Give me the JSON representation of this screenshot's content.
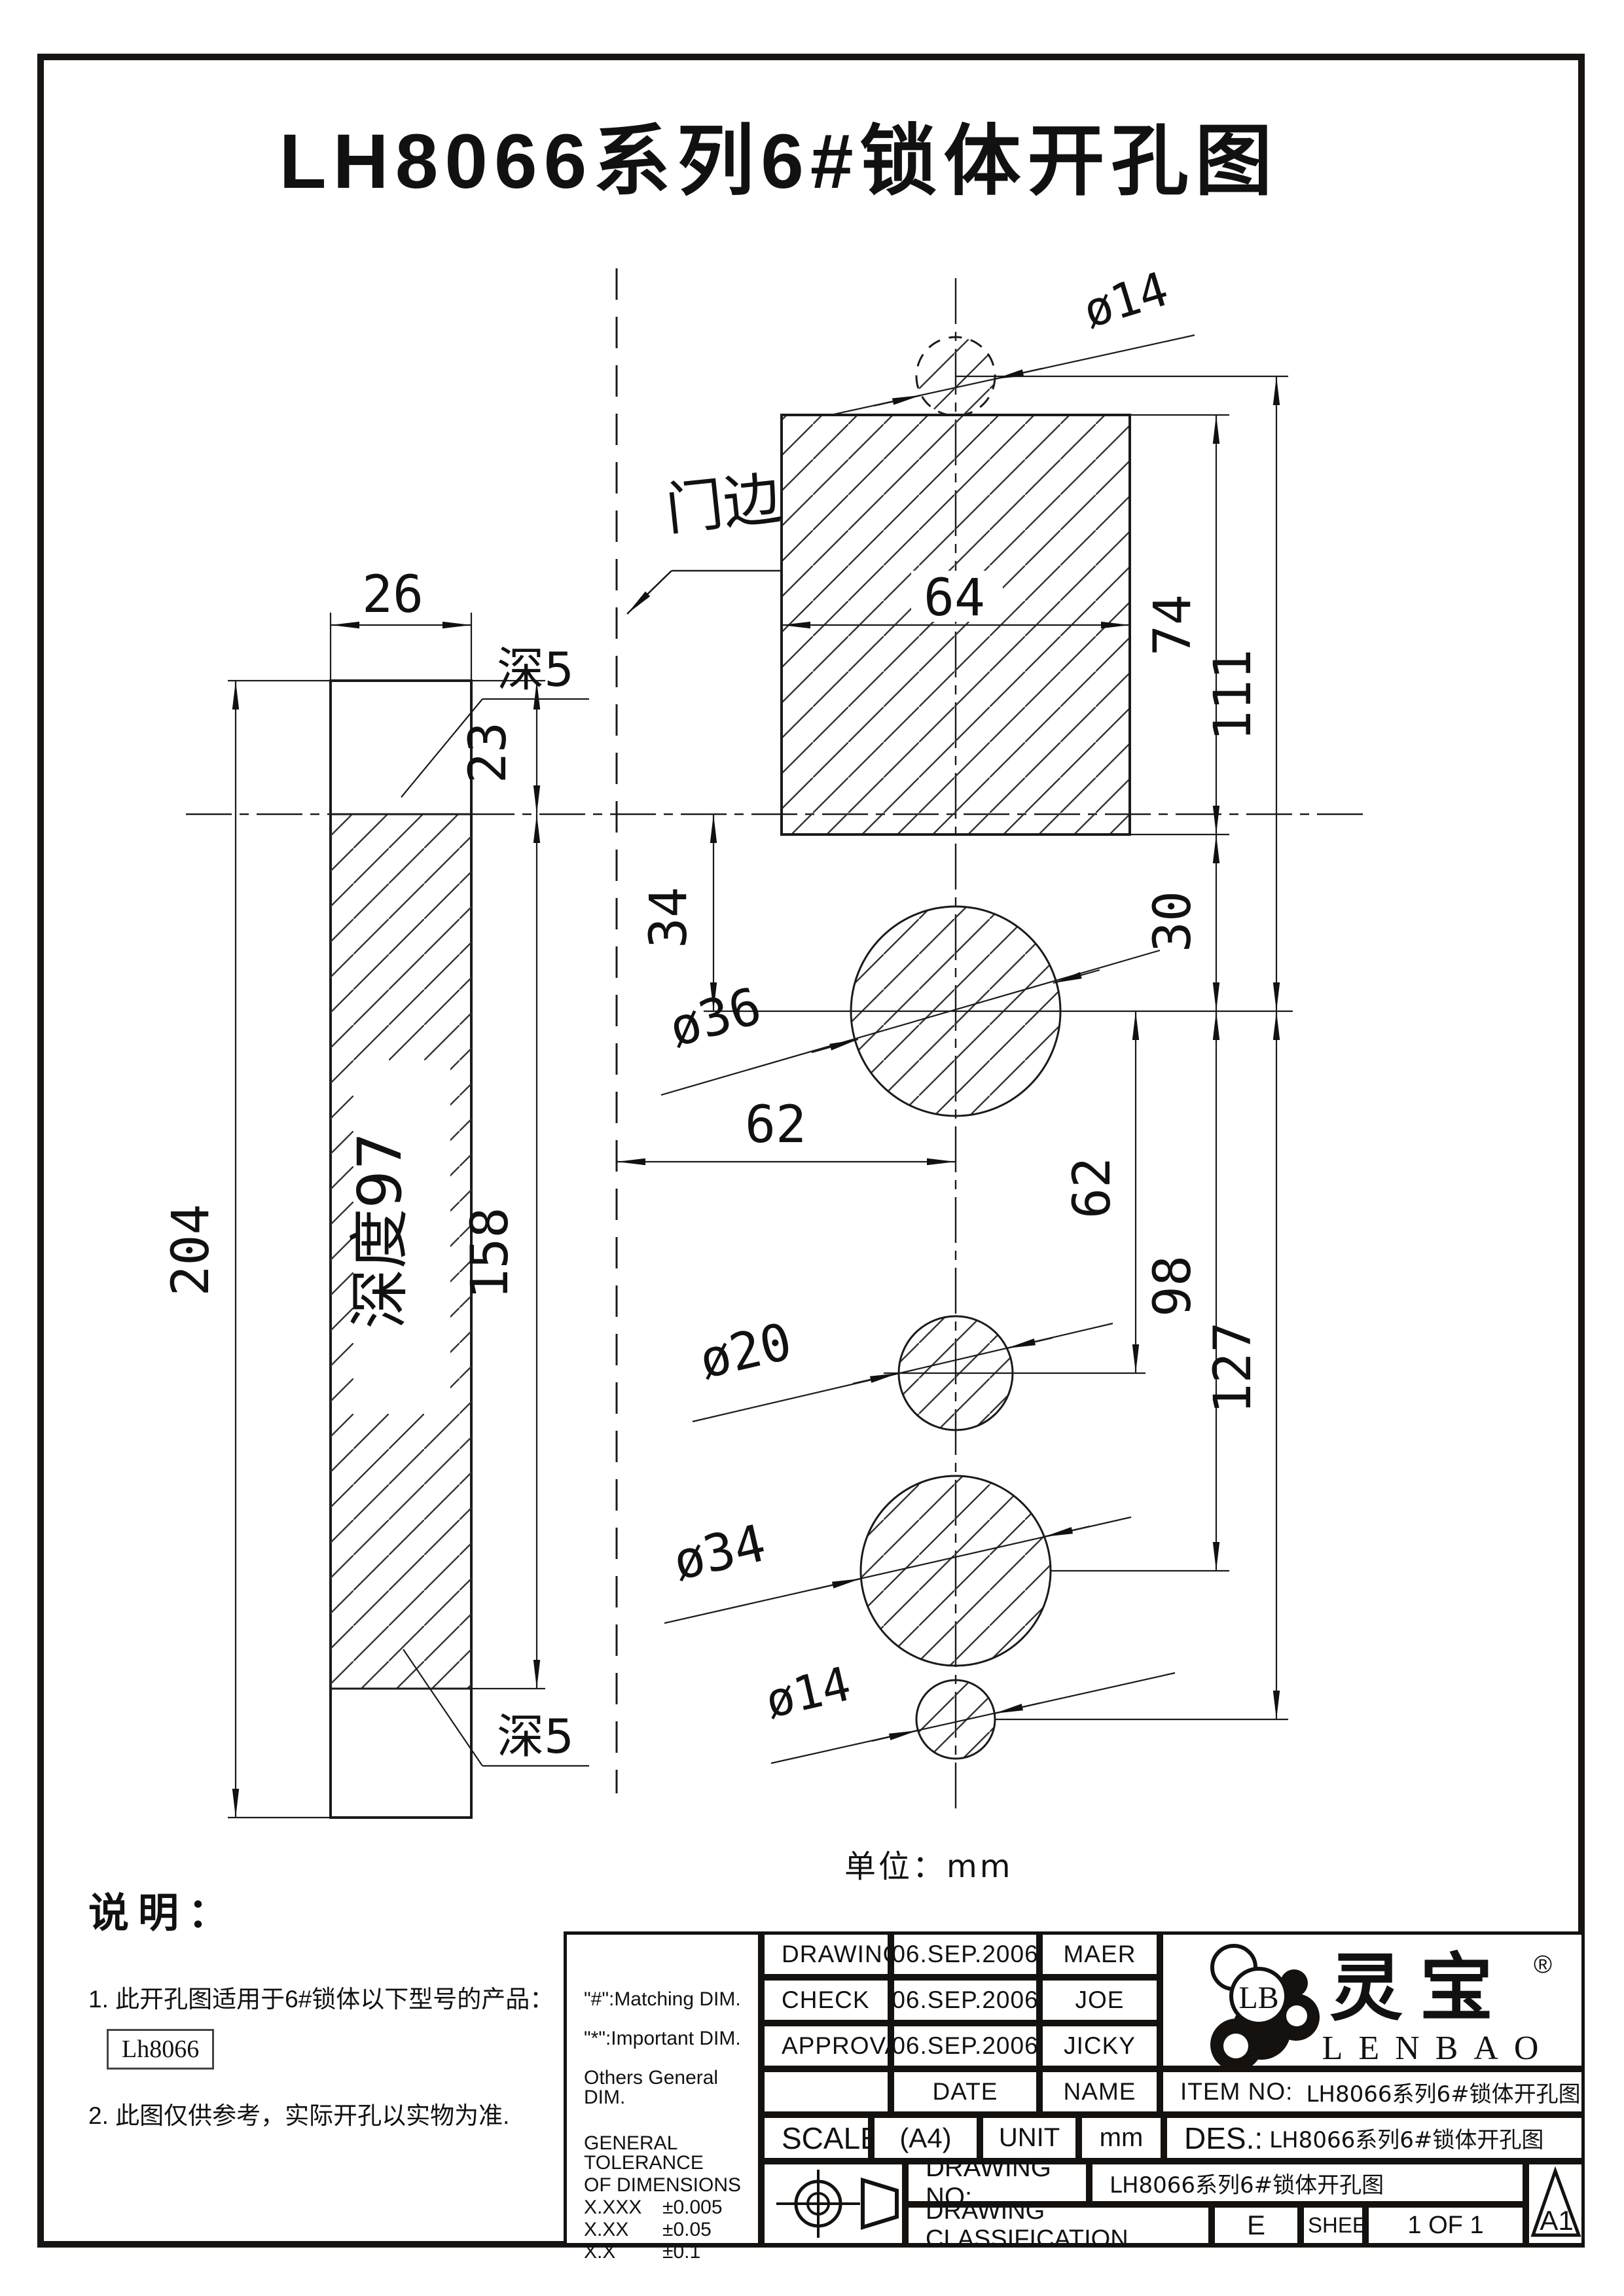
{
  "title": "LH8066系列6#锁体开孔图",
  "unit_note": "单位：mm",
  "drawing": {
    "door_edge_label": "门边",
    "depth_note_top": "深5",
    "depth_note_bottom": "深5",
    "depth_inside": "深度97",
    "dims": {
      "w26": "26",
      "d23": "23",
      "d204": "204",
      "d158": "158",
      "d64": "64",
      "d74": "74",
      "d111": "111",
      "d30": "30",
      "d34": "34",
      "d62v": "62",
      "d62h": "62",
      "d98": "98",
      "d127": "127",
      "dia14_top": "ø14",
      "dia36": "ø36",
      "dia20": "ø20",
      "dia34": "ø34",
      "dia14_bottom": "ø14"
    }
  },
  "notes": {
    "heading": "说明：",
    "item1": "1. 此开孔图适用于6#锁体以下型号的产品：",
    "model_box": "Lh8066",
    "item2": "2. 此图仅供参考，实际开孔以实物为准."
  },
  "titleblock": {
    "rows": [
      {
        "label": "DRAWING",
        "date": "06.SEP.2006",
        "name": "MAER"
      },
      {
        "label": "CHECK",
        "date": "06.SEP.2006",
        "name": "JOE"
      },
      {
        "label": "APPROVAL",
        "date": "06.SEP.2006",
        "name": "JICKY"
      }
    ],
    "date_header": "DATE",
    "name_header": "NAME",
    "item_no_label": "ITEM NO:",
    "item_no_value": "LH8066系列6#锁体开孔图",
    "scale_label": "SCALE",
    "scale_value": "(A4)",
    "unit_label": "UNIT",
    "unit_value": "mm",
    "des_label": "DES.:",
    "des_value": "LH8066系列6#锁体开孔图",
    "drawing_no_label": "DRAWING NO:",
    "drawing_no_value": "LH8066系列6#锁体开孔图",
    "classification_label": "DRAWING CLASSIFICATION",
    "classification_value": "E",
    "sheet_label": "SHEET",
    "sheet_value": "1 OF 1",
    "format_code": "A1",
    "side_notes": [
      "\"#\":Matching  DIM.",
      "\"*\":Important  DIM.",
      "Others General  DIM."
    ],
    "tolerance_title": [
      "GENERAL TOLERANCE",
      "OF DIMENSIONS"
    ],
    "tolerances": [
      [
        "X.XXX",
        "±0.005"
      ],
      [
        "X.XX",
        "±0.05"
      ],
      [
        "X.X",
        "±0.1"
      ]
    ]
  },
  "logo": {
    "monogram": "LB",
    "brand_cn": "灵宝",
    "brand_en": "LENBAO",
    "registered": "®"
  },
  "colors": {
    "ink": "#1a1a1a"
  }
}
